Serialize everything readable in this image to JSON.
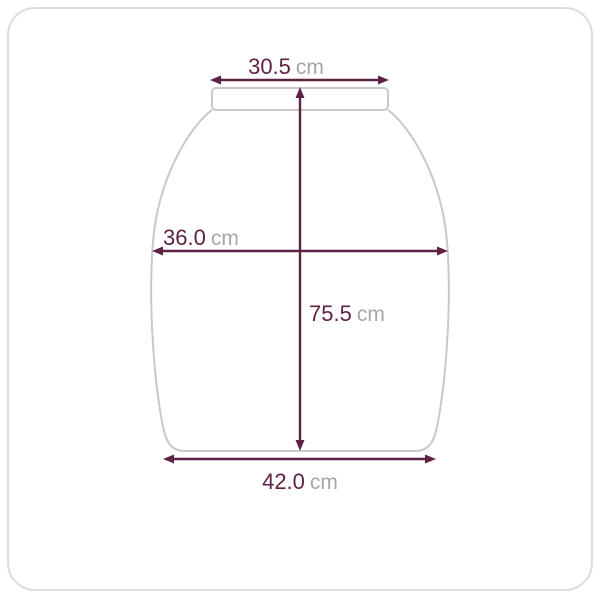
{
  "frame": {
    "border_color": "#dcdcdc"
  },
  "diagram": {
    "kind": "garment-size-measurement",
    "colors": {
      "dimension": "#5e2244",
      "unit_text": "#a6a6a6",
      "garment_outline": "#c9c9c9",
      "background": "#ffffff"
    },
    "measurements": {
      "top_width": {
        "value": "30.5",
        "unit": "cm"
      },
      "body_width": {
        "value": "36.0",
        "unit": "cm"
      },
      "length": {
        "value": "75.5",
        "unit": "cm"
      },
      "hem_width": {
        "value": "42.0",
        "unit": "cm"
      }
    }
  }
}
